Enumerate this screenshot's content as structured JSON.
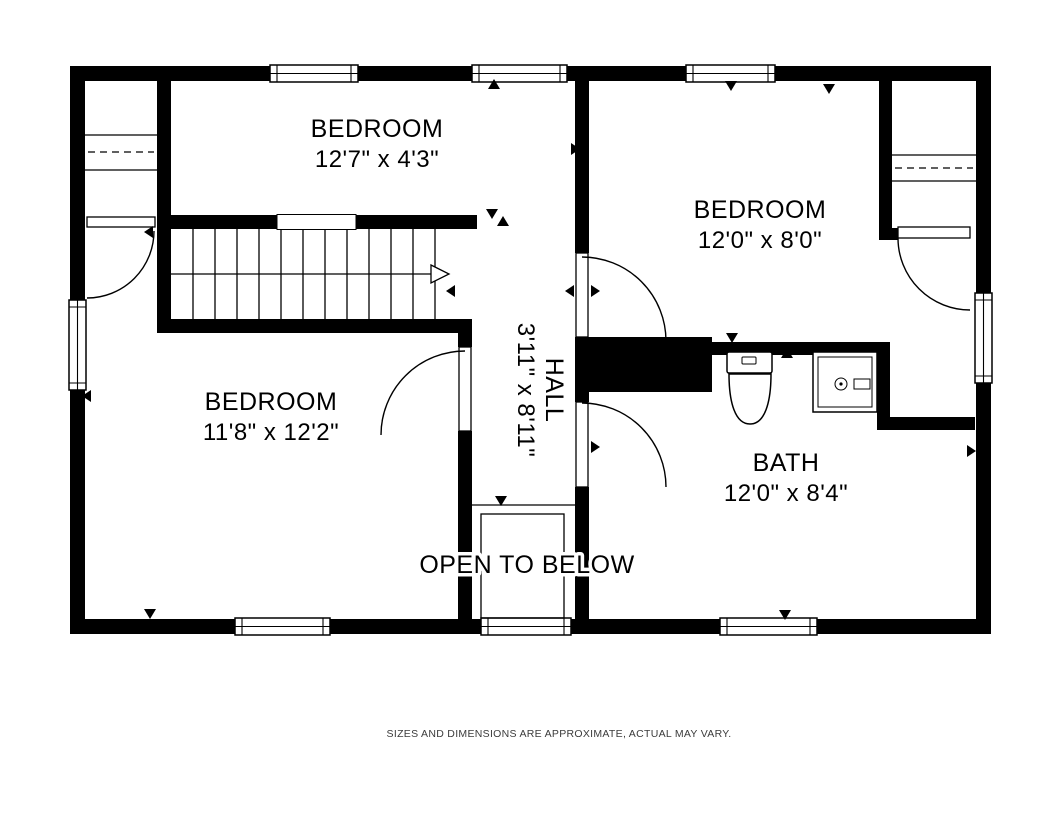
{
  "page": {
    "background_color": "#ffffff"
  },
  "floor_plan": {
    "wall_color": "#000000",
    "line_color": "#000000",
    "rooms": [
      {
        "id": "bedroom-top",
        "name": "BEDROOM",
        "dims": "12'7\" x 4'3\""
      },
      {
        "id": "bedroom-right",
        "name": "BEDROOM",
        "dims": "12'0\" x 8'0\""
      },
      {
        "id": "bedroom-left",
        "name": "BEDROOM",
        "dims": "11'8\" x 12'2\""
      },
      {
        "id": "bath",
        "name": "BATH",
        "dims": "12'0\" x 8'4\""
      },
      {
        "id": "hall",
        "name": "HALL",
        "dims": "3'11\" x 8'11\""
      }
    ],
    "annotations": {
      "open_to_below": "OPEN TO BELOW"
    },
    "fixtures": [
      "staircase",
      "toilet",
      "sink-vanity",
      "closet-rod-left",
      "closet-rod-right"
    ],
    "disclaimer": "SIZES AND DIMENSIONS ARE APPROXIMATE, ACTUAL MAY VARY."
  }
}
